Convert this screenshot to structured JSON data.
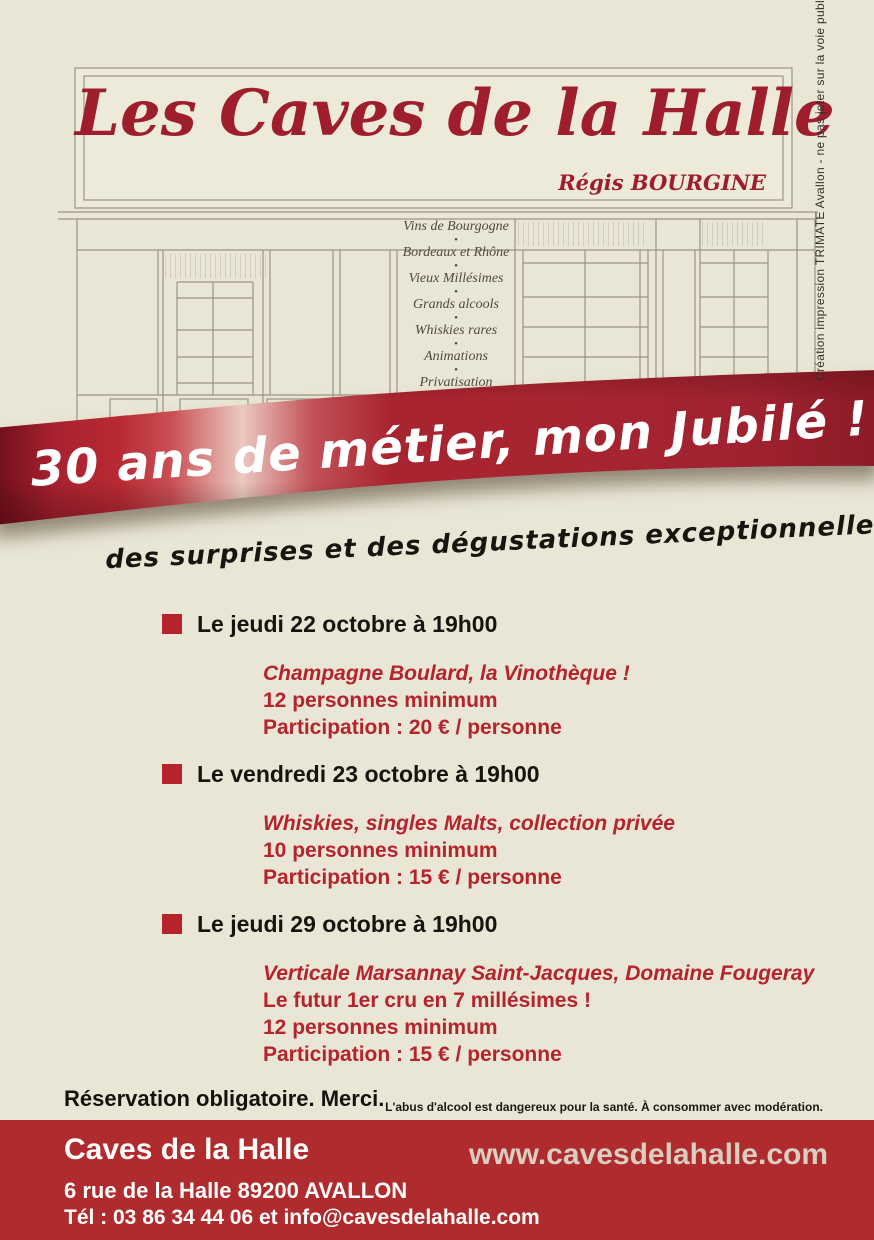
{
  "storefront": {
    "sign": {
      "title": "Les Caves de la Halle",
      "owner": "Régis BOURGINE"
    },
    "services": [
      "Vins de Bourgogne",
      "Bordeaux et Rhône",
      "Vieux Millésimes",
      "Grands alcools",
      "Whiskies rares",
      "Animations",
      "Privatisation"
    ]
  },
  "banner": {
    "headline": "30 ans de métier, mon Jubilé !",
    "subheadline": "des surprises et des dégustations exceptionnelles"
  },
  "events": [
    {
      "date": "Le jeudi 22 octobre à 19h00",
      "lines": [
        "Champagne Boulard, la Vinothèque !",
        "12 personnes minimum",
        "Participation : 20 € / personne"
      ]
    },
    {
      "date": "Le vendredi 23 octobre à 19h00",
      "lines": [
        "Whiskies, singles Malts, collection privée",
        "10 personnes minimum",
        "Participation : 15 € / personne"
      ]
    },
    {
      "date": "Le jeudi 29 octobre à 19h00",
      "lines": [
        "Verticale Marsannay Saint-Jacques, Domaine Fougeray",
        "Le futur 1er cru en 7 millésimes !",
        "12 personnes minimum",
        "Participation : 15 € / personne"
      ]
    }
  ],
  "notes": {
    "reservation": "Réservation obligatoire. Merci.",
    "health_warning": "L'abus d'alcool est dangereux pour la santé. À consommer avec modération."
  },
  "footer": {
    "name": "Caves de la Halle",
    "address": "6 rue de la Halle 89200 AVALLON",
    "contact": "Tél : 03 86 34 44 06 et info@cavesdelahalle.com",
    "website": "www.cavesdelahalle.com"
  },
  "credit": {
    "text": "Création impression TRIMATE Avallon - ne pas jeter sur la voie publique"
  },
  "colors": {
    "background": "#eae6d5",
    "title_red": "#9e1e2d",
    "accent_red": "#b5232d",
    "footer_red": "#b02b2e",
    "ribbon_dark": "#6e0e1a",
    "ribbon_bright": "#b32732",
    "ribbon_highlight": "#ecc9c1",
    "website_beige": "#d9cfc0",
    "sketch_line": "#9b9486"
  }
}
